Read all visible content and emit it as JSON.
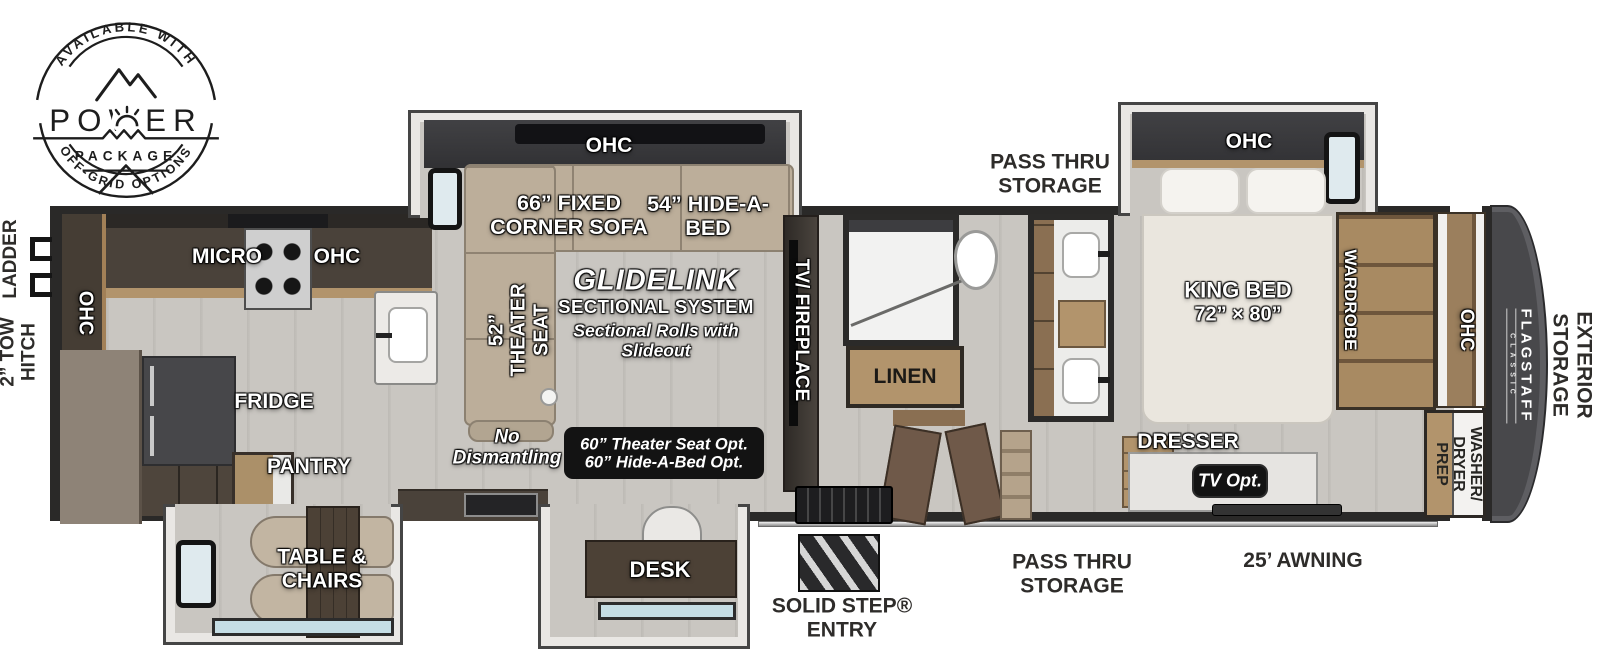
{
  "badge": {
    "top": "AVAILABLE WITH",
    "power": "POWER",
    "package": "PACKAGE",
    "bottom": "OFF-GRID OPTIONS"
  },
  "exterior": {
    "ladder": "LADDER",
    "tow_hitch": [
      "2” TOW",
      "HITCH"
    ],
    "pass_thru": [
      "PASS THRU",
      "STORAGE"
    ],
    "awning": "25’ AWNING",
    "solid_step": [
      "SOLID STEP®",
      "ENTRY"
    ],
    "exterior_storage": [
      "EXTERIOR",
      "STORAGE"
    ],
    "brand": "FLAGSTAFF",
    "brand_sub": "CLASSIC"
  },
  "labels": {
    "ohc": "OHC",
    "micro": "MICRO",
    "fridge": "FRIDGE",
    "pantry": "PANTRY",
    "table_chairs": [
      "TABLE &",
      "CHAIRS"
    ],
    "desk": "DESK",
    "corner_sofa": [
      "66” FIXED",
      "CORNER SOFA"
    ],
    "hide_a_bed": [
      "54” HIDE-A-",
      "BED"
    ],
    "theater_seat": [
      "52”",
      "THEATER",
      "SEAT"
    ],
    "glidelink": "GLIDELINK",
    "sectional_system": "SECTIONAL SYSTEM",
    "sectional_note": [
      "Sectional Rolls with",
      "Slideout"
    ],
    "no_dismantling": [
      "No",
      "Dismantling"
    ],
    "options": [
      "60” Theater Seat Opt.",
      "60” Hide-A-Bed Opt."
    ],
    "tv_fireplace": "TV/ FIREPLACE",
    "linen": "LINEN",
    "king_bed": [
      "KING BED",
      "72” × 80”"
    ],
    "wardrobe": "WARDROBE",
    "dresser": "DRESSER",
    "tv_opt": "TV Opt.",
    "washer_dryer": [
      "WASHER/",
      "DRYER",
      "PREP"
    ]
  },
  "colors": {
    "wall": "#2a2928",
    "floor": "#c8c5c0",
    "sofa": "#bcae9a",
    "wood": "#b2946c",
    "cabinet": "#4a423a",
    "front_cap": "#48484b",
    "black_box": "#131313",
    "window": "#c5dde4"
  }
}
